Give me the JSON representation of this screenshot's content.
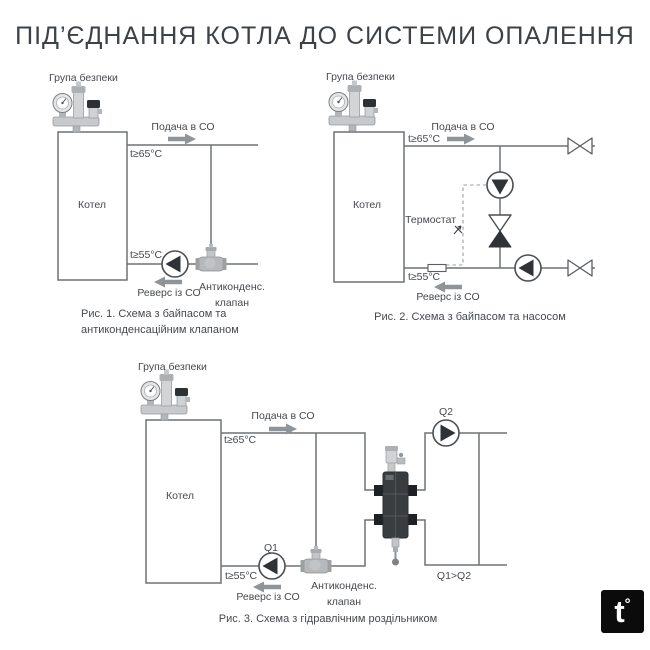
{
  "title": "ПІД’ЄДНАННЯ КОТЛА ДО СИСТЕМИ ОПАЛЕННЯ",
  "colors": {
    "pipe": "#6d7276",
    "text": "#45494e",
    "pump_fill": "#2f3337",
    "arrow": "#8f9499",
    "separator_body": "#3a3d40",
    "logo_bg": "#0b0b0b"
  },
  "logo": {
    "letter": "t",
    "degree": "°"
  },
  "diagram1": {
    "safety_group_label": "Група безпеки",
    "boiler_label": "Котел",
    "supply_label": "Подача в СО",
    "supply_temp": "t≥65°C",
    "return_temp": "t≥55°C",
    "return_label": "Реверс із СО",
    "valve_label_line1": "Антиконденс.",
    "valve_label_line2": "клапан",
    "caption_line1": "Рис. 1. Схема з байпасом та",
    "caption_line2": "антиконденсаційним клапаном"
  },
  "diagram2": {
    "safety_group_label": "Група безпеки",
    "boiler_label": "Котел",
    "supply_label": "Подача в СО",
    "supply_temp": "t≥65°C",
    "thermostat_label": "Термостат",
    "return_temp": "t≥55°C",
    "return_label": "Реверс із СО",
    "caption": "Рис. 2. Схема з байпасом та насосом"
  },
  "diagram3": {
    "safety_group_label": "Група безпеки",
    "boiler_label": "Котел",
    "supply_label": "Подача в СО",
    "supply_temp": "t≥65°C",
    "pump_secondary_label": "Q2",
    "pump_primary_label": "Q1",
    "flow_note": "Q1>Q2",
    "return_temp": "t≥55°C",
    "return_label": "Реверс із СО",
    "valve_label_line1": "Антиконденс.",
    "valve_label_line2": "клапан",
    "caption": "Рис. 3. Схема з гідравлічним роздільником"
  }
}
